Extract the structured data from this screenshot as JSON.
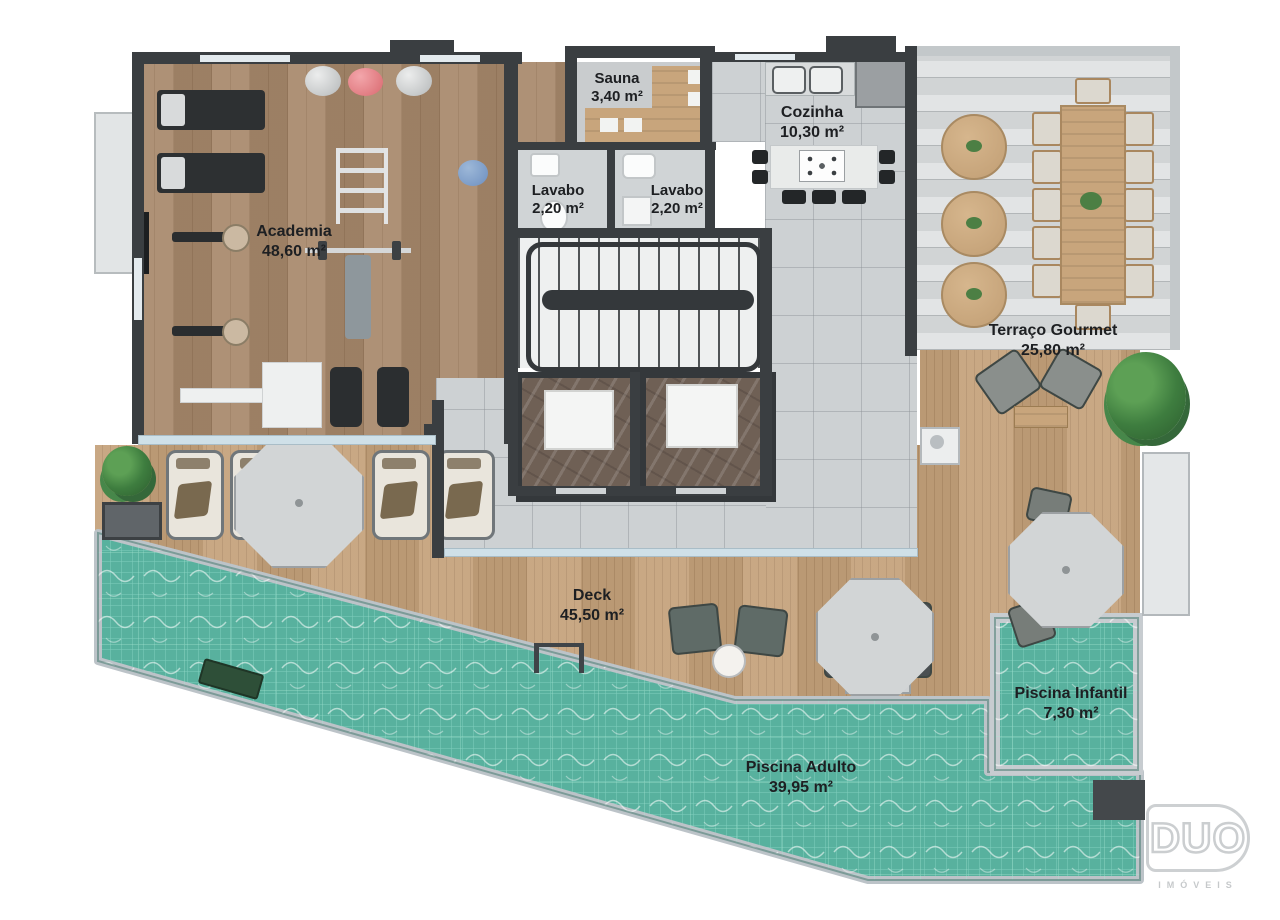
{
  "plan": {
    "rooms": [
      {
        "name": "Academia",
        "area": "48,60 m²"
      },
      {
        "name": "Sauna",
        "area": "3,40 m²"
      },
      {
        "name": "Lavabo",
        "area": "2,20 m²"
      },
      {
        "name": "Lavabo",
        "area": "2,20 m²"
      },
      {
        "name": "Cozinha",
        "area": "10,30 m²"
      },
      {
        "name": "Terraço Gourmet",
        "area": "25,80 m²"
      },
      {
        "name": "Deck",
        "area": "45,50 m²"
      },
      {
        "name": "Piscina Adulto",
        "area": "39,95 m²"
      },
      {
        "name": "Piscina Infantil",
        "area": "7,30 m²"
      }
    ],
    "logo": {
      "brand": "DUO",
      "subtitle": "IMÓVEIS"
    },
    "colors": {
      "pool_water": "#58b19e",
      "pool_grid": "#8ed9c7",
      "gym_wood": "#a5876a",
      "deck_wood": "#bf9c76",
      "wall": "#3a3e41",
      "tile": "#cdd1d3",
      "ball_red": "#e8848b"
    }
  }
}
